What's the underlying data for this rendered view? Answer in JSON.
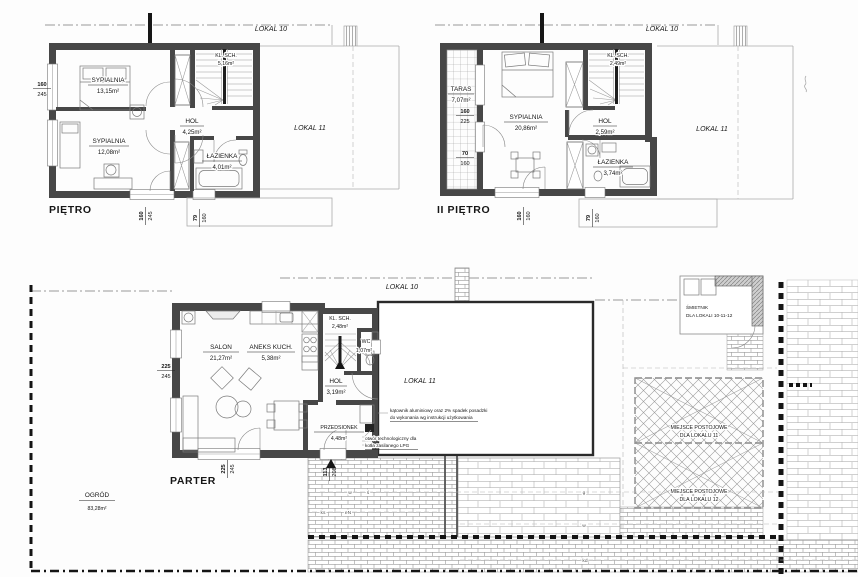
{
  "p1": {
    "title": "PIĘTRO",
    "lokal10": "LOKAL 10",
    "lokal11": "LOKAL 11",
    "r1n": "SYPIALNIA",
    "r1a": "13,15m²",
    "r2n": "SYPIALNIA",
    "r2a": "12,08m²",
    "r3n": "HOL",
    "r3a": "4,25m²",
    "r4n": "ŁAZIENKA",
    "r4a": "4,01m²",
    "r5n": "KL. SCH.",
    "r5a": "5,16m²",
    "dimL1": "160",
    "dimL2": "245",
    "dimB1a": "160",
    "dimB1b": "245",
    "dimB2a": "79",
    "dimB2b": "160"
  },
  "p2": {
    "title": "II PIĘTRO",
    "lokal10": "LOKAL 10",
    "lokal11": "LOKAL 11",
    "r1n": "TARAS",
    "r1a": "7,07m²",
    "r2n": "SYPIALNIA",
    "r2a": "20,86m²",
    "r3n": "HOL",
    "r3a": "2,59m²",
    "r4n": "ŁAZIENKA",
    "r4a": "3,74m²",
    "r5n": "KL. SCH.",
    "r5a": "2,49m²",
    "dimL1a": "160",
    "dimL1b": "225",
    "dimL2a": "70",
    "dimL2b": "160",
    "dimB1a": "160",
    "dimB1b": "160",
    "dimB2a": "79",
    "dimB2b": "160"
  },
  "p0": {
    "title": "PARTER",
    "lokal10": "LOKAL 10",
    "lokal11": "LOKAL 11",
    "r1n": "SALON",
    "r1a": "21,27m²",
    "r2n": "ANEKS KUCH.",
    "r2a": "5,38m²",
    "r3n": "KL. SCH.",
    "r3a": "2,48m²",
    "r4n": "WC",
    "r4a": "1,07m²",
    "r5n": "HOL",
    "r5a": "3,19m²",
    "r6n": "PRZEDSIONEK",
    "r6a": "4,48m²",
    "dimL1": "225",
    "dimL2": "245",
    "dimB1a": "225",
    "dimB1b": "245",
    "dimE1": "113",
    "dimE2": "208",
    "ogrod_n": "OGRÓD",
    "ogrod_a": "83,28m²",
    "smietnik1": "ŚMIETNIK",
    "smietnik2": "DLA LOKALI 10-11-12",
    "park11a": "MIEJSCE POSTOJOWE",
    "park11b": "DLA LOKALU 11",
    "park12a": "MIEJSCE POSTOJOWE",
    "park12b": "DLA LOKALU 12",
    "note1a": "kątownik aluminiowy oraz 2% spadek posadzki",
    "note1b": "do wykonania wg instrukcji użytkowania",
    "note2a": "otwór technologiczny dla",
    "note2b": "kotła zasilanego LPG",
    "u1": "w",
    "u2": "ś",
    "u3": "g",
    "u4": "ks",
    "u5": "eN",
    "u6": "w",
    "u7": "kd"
  }
}
